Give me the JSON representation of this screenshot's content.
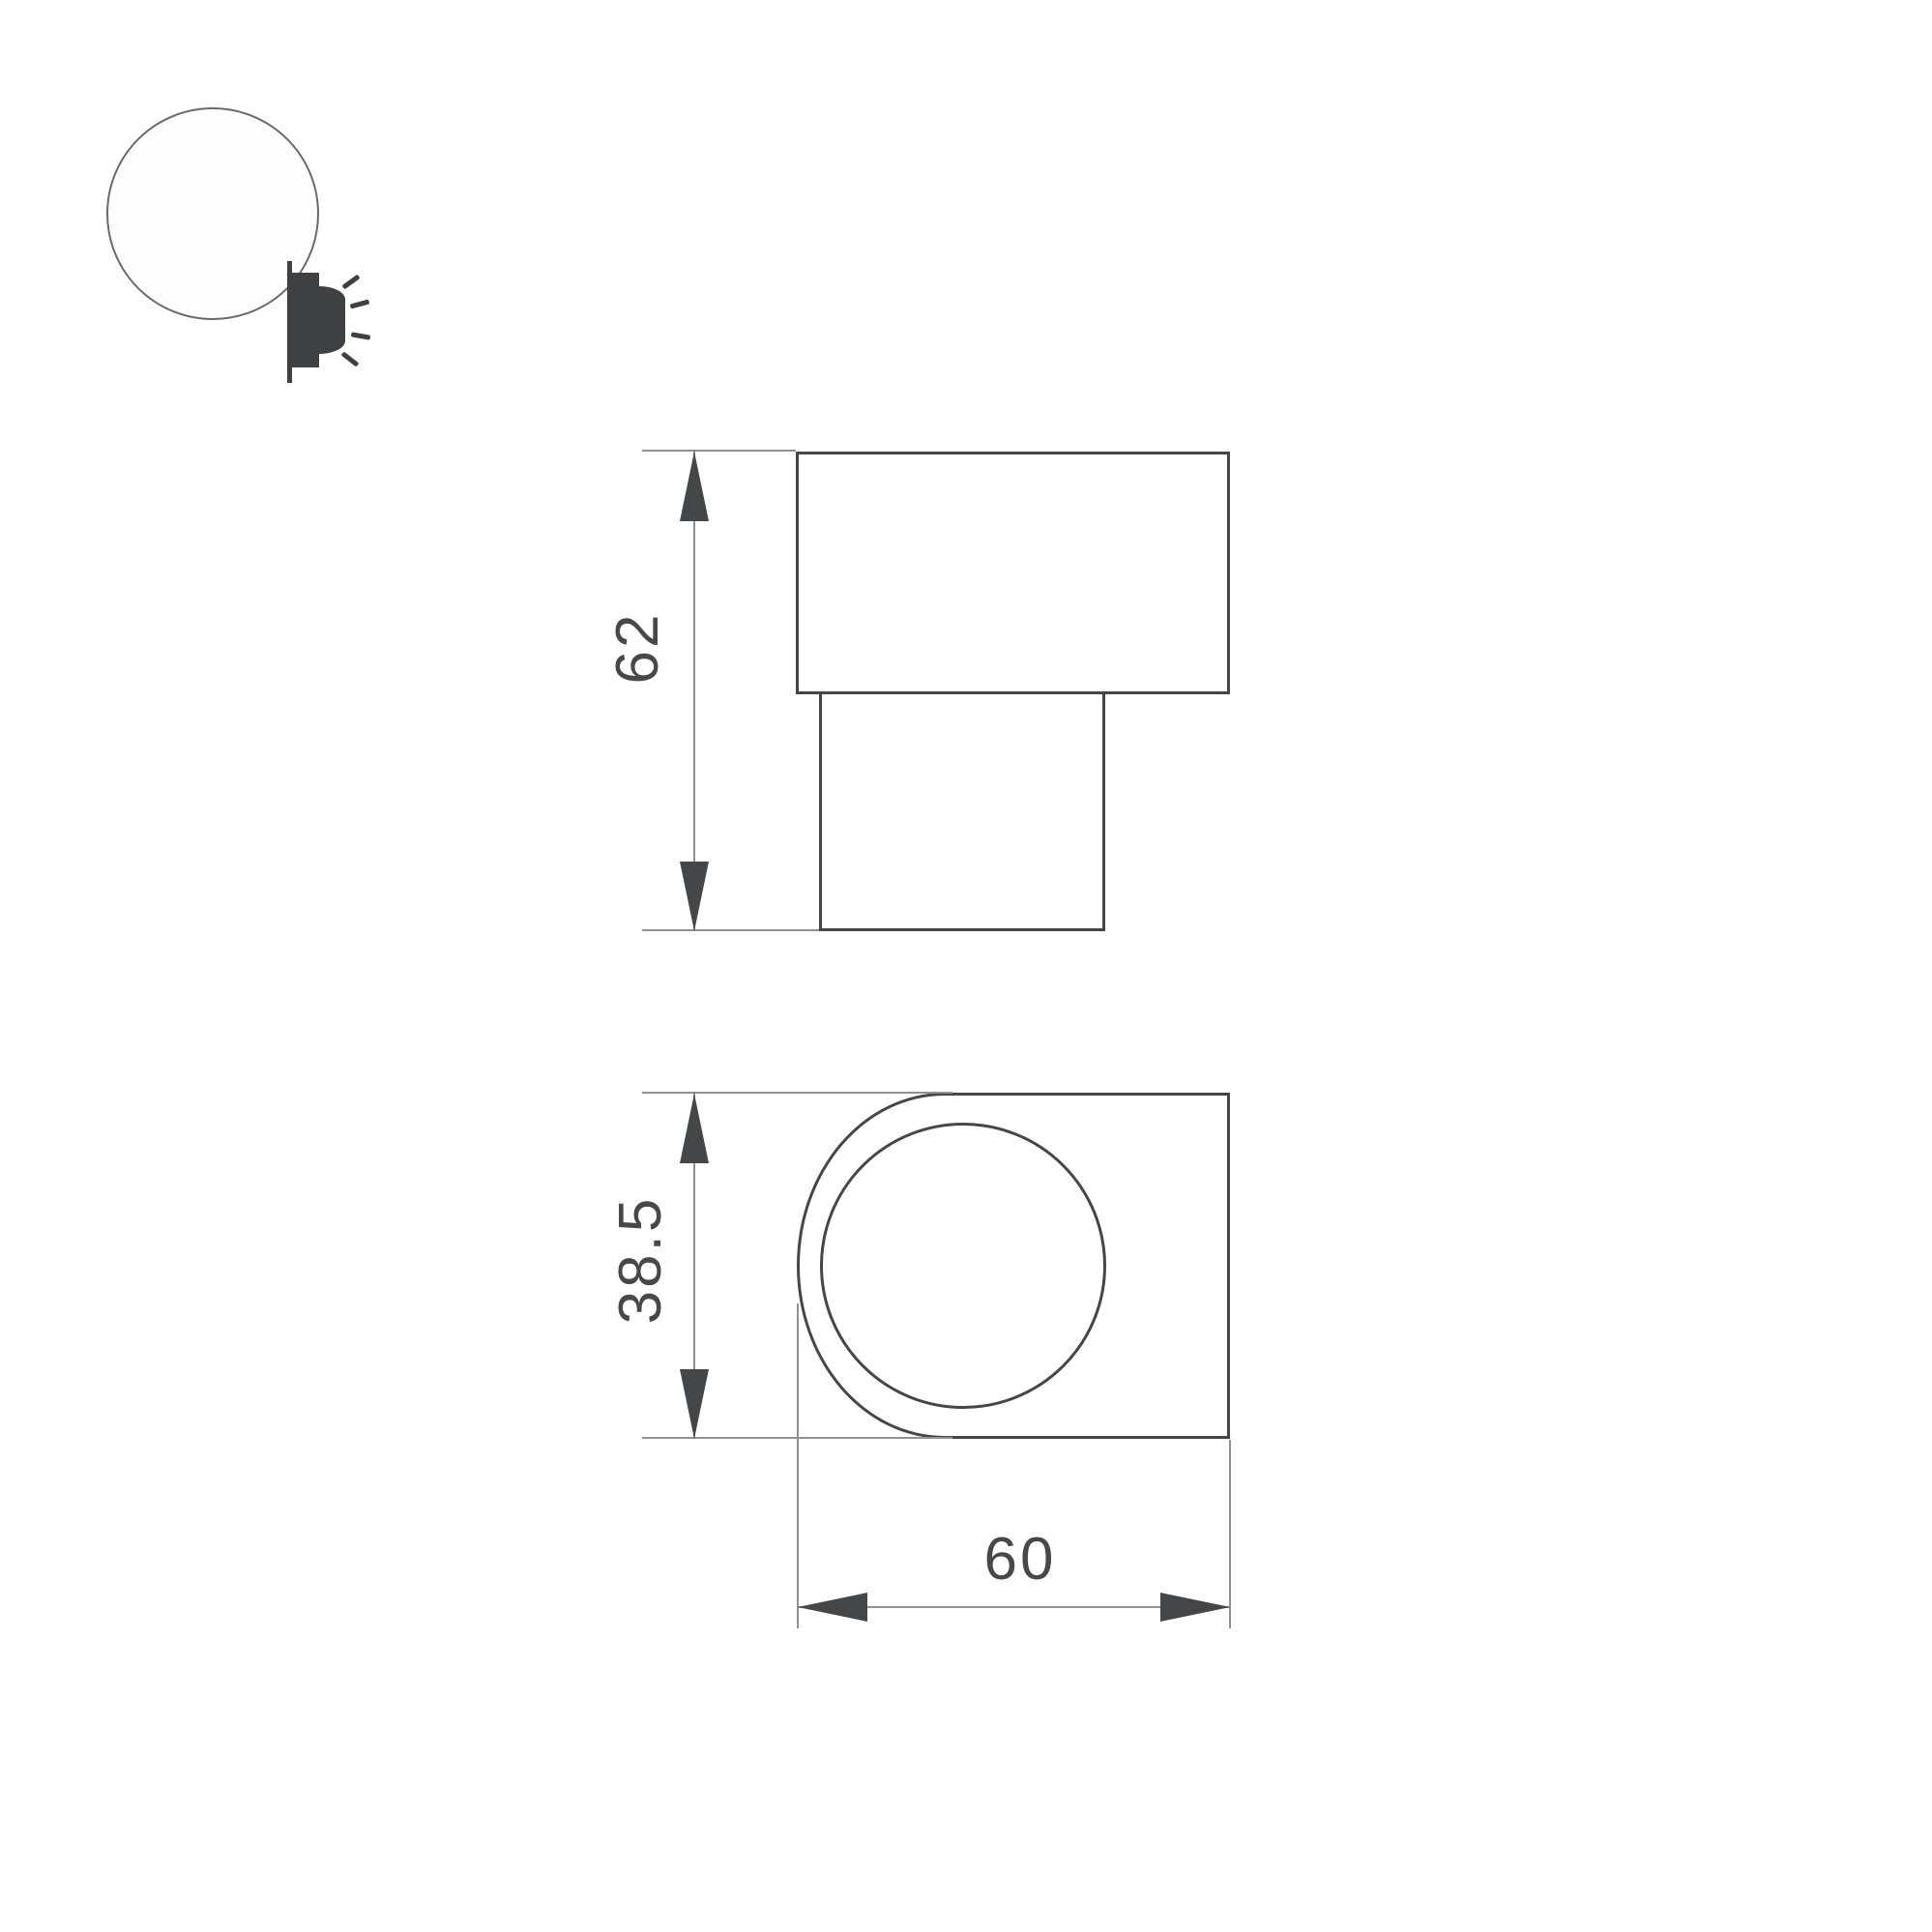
{
  "page": {
    "background": "#ffffff"
  },
  "colors": {
    "outline_dark": "#44474a",
    "dim_line_gray": "#8f9193",
    "text_gray": "#46494c"
  },
  "logo": {
    "icon": "wall-lamp-emitting-light-icon"
  },
  "side_view": {
    "height_dimension": {
      "value": "62"
    }
  },
  "front_view": {
    "depth_dimension": {
      "value": "38.5"
    },
    "width_dimension": {
      "value": "60"
    }
  }
}
